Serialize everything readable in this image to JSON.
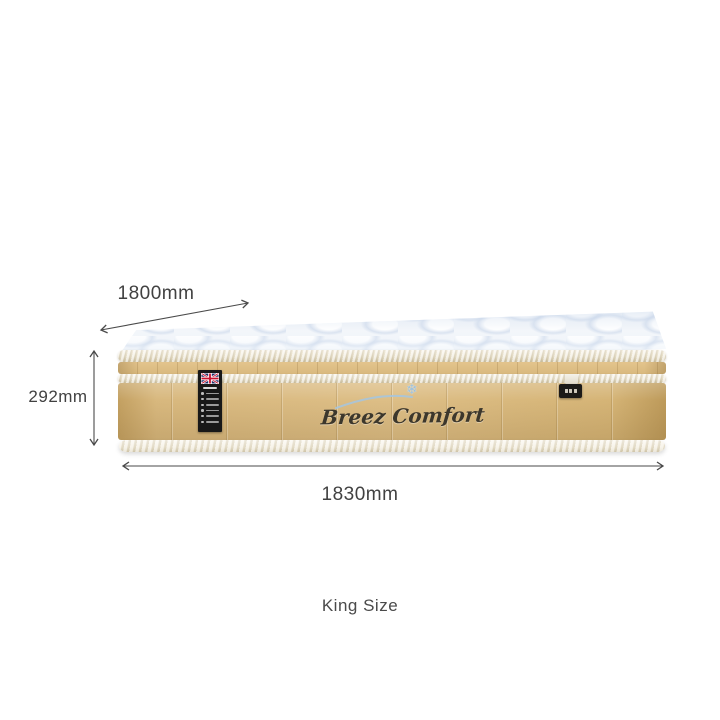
{
  "product": {
    "brand_embroidery": "Breez Comfort",
    "size_name": "King Size"
  },
  "dimensions": {
    "depth": "1800mm",
    "height": "292mm",
    "width": "1830mm"
  },
  "icons": {
    "snowflake": "❄",
    "union_jack": "union-jack-flag"
  },
  "colors": {
    "annotation_text": "#414141",
    "arrow": "#4a4a4a",
    "mattress_tan": "#d5b67b",
    "piping_cream": "#efe8d5",
    "top_quilt_white": "#f4f7fb",
    "quilt_shadow_blue": "#ccd9ea",
    "care_label_bg": "#181818",
    "embroidery_thread": "#3c372c",
    "swirl_blue": "#a5c6e0"
  }
}
